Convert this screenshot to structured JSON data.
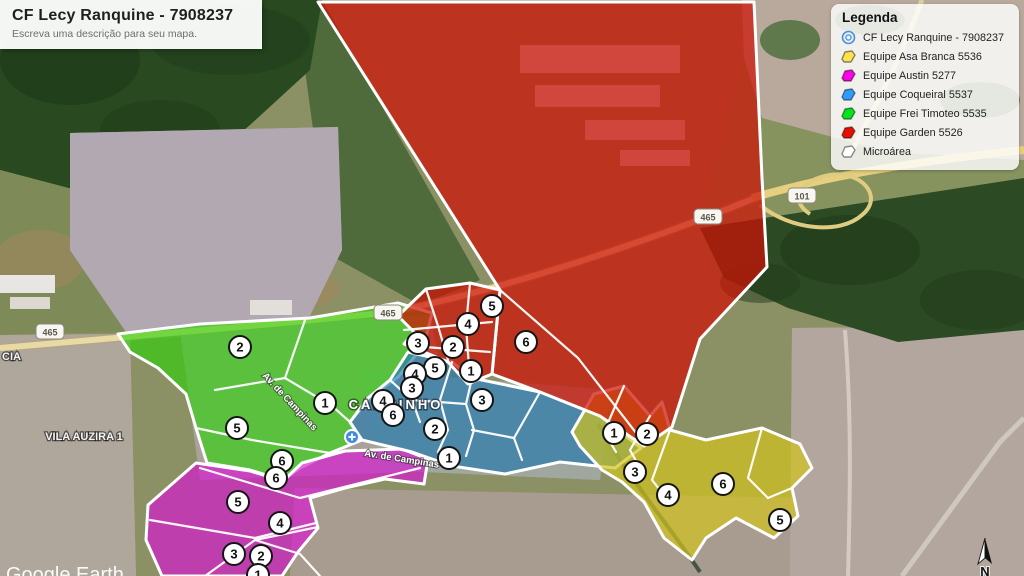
{
  "title_card": {
    "title": "CF Lecy Ranquine - 7908237",
    "subtitle": "Escreva uma descrição para seu mapa."
  },
  "legend": {
    "title": "Legenda",
    "items": [
      {
        "label": "CF Lecy Ranquine - 7908237",
        "icon": "health-facility-icon",
        "color": "#4a8fd9"
      },
      {
        "label": "Equipe Asa Branca 5536",
        "icon": "polygon-swatch",
        "color": "#ffe14d"
      },
      {
        "label": "Equipe Austin 5277",
        "icon": "polygon-swatch",
        "color": "#ff00e6"
      },
      {
        "label": "Equipe Coqueiral 5537",
        "icon": "polygon-swatch",
        "color": "#2e9bff"
      },
      {
        "label": "Equipe Frei Timoteo 5535",
        "icon": "polygon-swatch",
        "color": "#00e61a"
      },
      {
        "label": "Equipe Garden 5526",
        "icon": "polygon-swatch",
        "color": "#e81000"
      },
      {
        "label": "Microárea",
        "icon": "polygon-swatch",
        "color": "#ffffff"
      }
    ]
  },
  "map": {
    "regions": [
      {
        "name": "Equipe Garden 5526",
        "color": "#cf1005"
      },
      {
        "name": "Equipe Frei Timoteo 5535",
        "color": "#2bd206"
      },
      {
        "name": "Equipe Coqueiral 5537",
        "color": "#2176ad"
      },
      {
        "name": "Equipe Austin 5277",
        "color": "#da13d4"
      },
      {
        "name": "Equipe Asa Branca 5536",
        "color": "#d2c31d"
      }
    ],
    "microarea_markers": [
      {
        "n": "2",
        "x": 240,
        "y": 347
      },
      {
        "n": "1",
        "x": 325,
        "y": 403
      },
      {
        "n": "5",
        "x": 237,
        "y": 428
      },
      {
        "n": "6",
        "x": 282,
        "y": 461
      },
      {
        "n": "5",
        "x": 492,
        "y": 306
      },
      {
        "n": "4",
        "x": 468,
        "y": 324
      },
      {
        "n": "3",
        "x": 418,
        "y": 343
      },
      {
        "n": "2",
        "x": 453,
        "y": 347
      },
      {
        "n": "6",
        "x": 526,
        "y": 342
      },
      {
        "n": "1",
        "x": 471,
        "y": 371
      },
      {
        "n": "5",
        "x": 435,
        "y": 368
      },
      {
        "n": "4",
        "x": 415,
        "y": 374
      },
      {
        "n": "3",
        "x": 412,
        "y": 388
      },
      {
        "n": "4",
        "x": 383,
        "y": 401
      },
      {
        "n": "6",
        "x": 393,
        "y": 415
      },
      {
        "n": "3",
        "x": 482,
        "y": 400
      },
      {
        "n": "2",
        "x": 435,
        "y": 429
      },
      {
        "n": "1",
        "x": 449,
        "y": 458
      },
      {
        "n": "6",
        "x": 276,
        "y": 478
      },
      {
        "n": "5",
        "x": 238,
        "y": 502
      },
      {
        "n": "4",
        "x": 280,
        "y": 523
      },
      {
        "n": "3",
        "x": 234,
        "y": 554
      },
      {
        "n": "2",
        "x": 261,
        "y": 556
      },
      {
        "n": "1",
        "x": 258,
        "y": 575
      },
      {
        "n": "1",
        "x": 614,
        "y": 433
      },
      {
        "n": "2",
        "x": 647,
        "y": 434
      },
      {
        "n": "3",
        "x": 635,
        "y": 472
      },
      {
        "n": "4",
        "x": 668,
        "y": 495
      },
      {
        "n": "6",
        "x": 723,
        "y": 484
      },
      {
        "n": "5",
        "x": 780,
        "y": 520
      }
    ],
    "road_shields": [
      {
        "label": "465",
        "x": 50,
        "y": 332
      },
      {
        "label": "465",
        "x": 388,
        "y": 313
      },
      {
        "label": "465",
        "x": 708,
        "y": 217
      },
      {
        "label": "101",
        "x": 802,
        "y": 196
      }
    ],
    "labels": {
      "cia": "CIA",
      "vila_auzira": "VILA AUZIRA 1",
      "campinho": "CAMPINHO",
      "av_campinas": "Av. de Campinas",
      "watermark": "Google Earth",
      "compass": "N"
    }
  }
}
